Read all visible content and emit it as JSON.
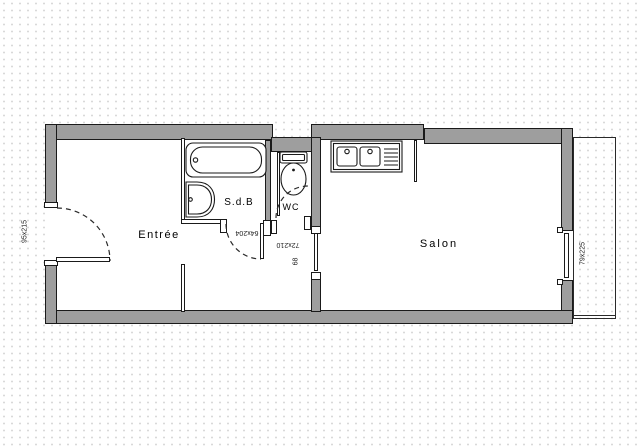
{
  "title": "Apartment floor plan",
  "rooms": {
    "entree": {
      "label": "Entrée"
    },
    "sdb": {
      "label": "S.d.B"
    },
    "wc": {
      "label": "WC"
    },
    "salon": {
      "label": "Salon"
    }
  },
  "dimensions": {
    "entry_door": "95x215",
    "sdb_door": "64x204",
    "salon_door": "72x210",
    "wc_door": "68",
    "salon_window": "79x225"
  },
  "fixtures": [
    "bathtub-icon",
    "washbasin-icon",
    "toilet-icon",
    "kitchen-sink-icon",
    "entry-door-arc",
    "sdb-door-arc",
    "wc-door-arc",
    "window",
    "balcony"
  ],
  "colors": {
    "wall_fill": "#9e9e9e",
    "line": "#1a1a1a",
    "background_dot": "#d9d9d9",
    "floor": "#ffffff"
  }
}
